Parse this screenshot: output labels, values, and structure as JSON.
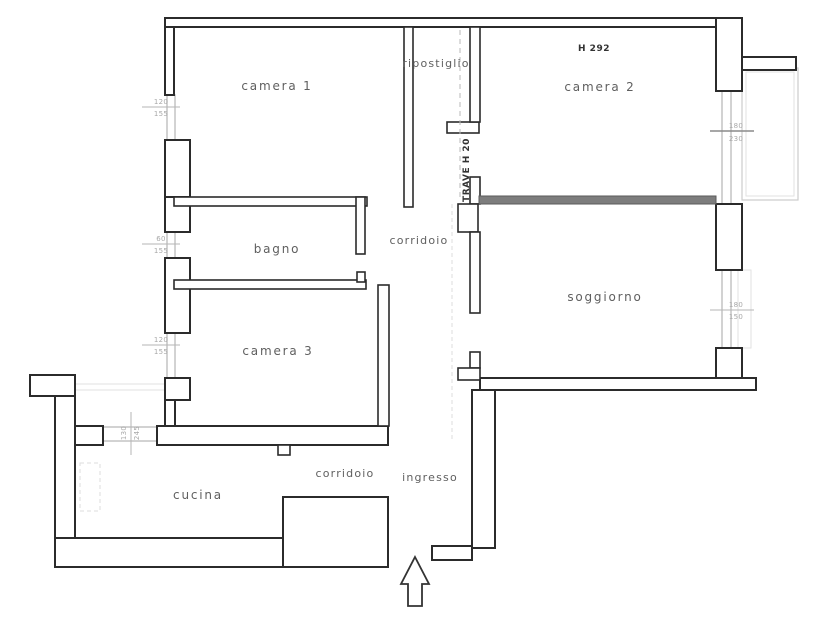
{
  "plan": {
    "rooms": {
      "camera1": "camera 1",
      "ripostiglio": "ripostiglio",
      "camera2": "camera 2",
      "bagno": "bagno",
      "corridoio_top": "corridoio",
      "soggiorno": "soggiorno",
      "camera3": "camera 3",
      "cucina": "cucina",
      "corridoio_bottom": "corridoio",
      "ingresso": "ingresso"
    },
    "notes": {
      "ceiling_height": "H 292",
      "beam": "TRAVE H 20"
    },
    "openings": {
      "camera1_window": {
        "w": "120",
        "h": "155"
      },
      "bagno_window": {
        "w": "60",
        "h": "155"
      },
      "camera3_window": {
        "w": "120",
        "h": "155"
      },
      "cucina_window": {
        "w": "130",
        "h": "245"
      },
      "camera2_window": {
        "w": "180",
        "h": "230"
      },
      "soggiorno_window": {
        "w": "180",
        "h": "150"
      }
    },
    "colors": {
      "wall": "#2b2b2b",
      "label": "#5f5f5f",
      "dim": "#a8a8a8",
      "paper": "#ffffff",
      "balcony": "#cccccc"
    }
  }
}
